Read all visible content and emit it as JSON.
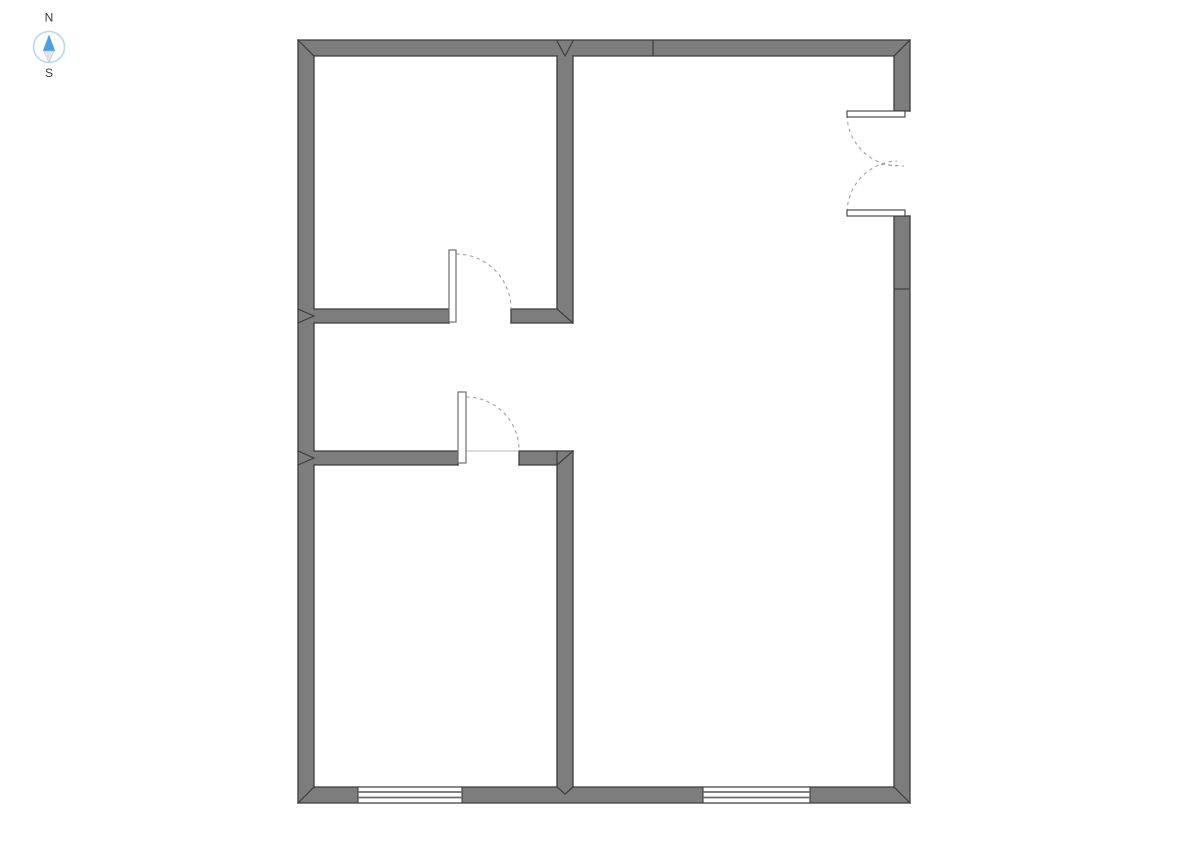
{
  "canvas": {
    "type": "floor-plan-drawing",
    "background": "white"
  },
  "compass": {
    "north_label": "N",
    "south_label": "S"
  },
  "plan_inventory": {
    "rooms_visible": 3,
    "single_doors": 2,
    "double_doors": 1,
    "windows": 2,
    "wall_passage_openings": 1
  },
  "colors": {
    "background": "#ffffff",
    "wall_fill": "#7d7d7d",
    "wall_stroke": "#3d3d3d",
    "door_arc": "#a3a3a3",
    "door_leaf_stroke": "#6f6f6f",
    "threshold": "#b8b8b8",
    "window_line": "#6e6e6e",
    "compass_ring": "#b5d8f2",
    "compass_north": "#4aa1e3",
    "compass_south": "#e2e2e2",
    "label_text": "#3a3a3a"
  }
}
